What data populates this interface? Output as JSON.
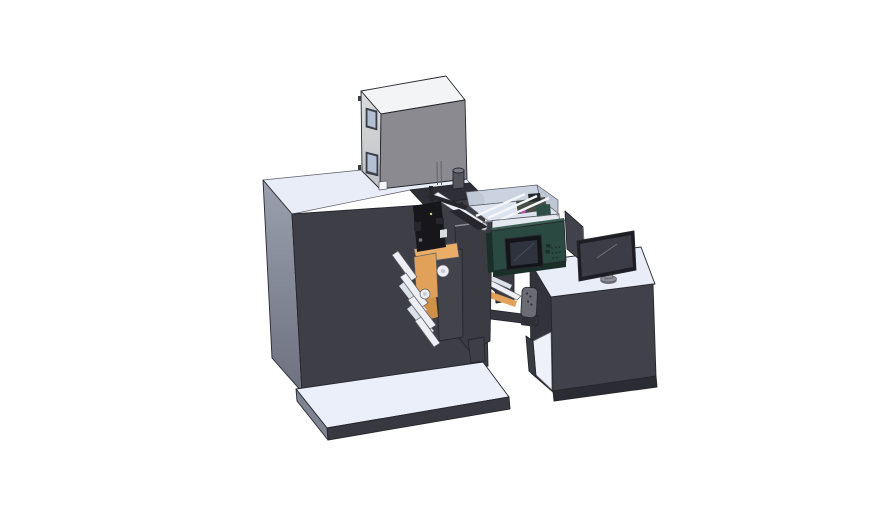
{
  "scene": {
    "description": "Isometric 3D CAD rendering of a compact label printing press: dark cabinet on a light base platform, top-mounted grey dryer box, unwind and rewind web rollers with orange material rolls, a transparent print-engine enclosure, a teal HMI screen unit, and an operator desk with a desktop monitor.",
    "background_color": "#ffffff"
  },
  "parts": {
    "machine_body": {
      "label": "main-press-cabinet"
    },
    "base_platform": {
      "label": "floor-base-platform"
    },
    "dryer_box": {
      "label": "top-dryer-box"
    },
    "web_section": {
      "label": "unwind-rewind-web-path"
    },
    "print_enclosure": {
      "label": "transparent-print-engine-enclosure"
    },
    "hmi_unit": {
      "label": "teal-hmi-screen-unit"
    },
    "operator_desk": {
      "label": "operator-desk"
    },
    "monitor": {
      "label": "desktop-monitor"
    }
  },
  "colors": {
    "bg": "#ffffff",
    "machine_top": "#e8edf7",
    "machine_front": "#3e3e47",
    "machine_side_top": "#9aa0ae",
    "machine_side_bottom": "#6d7180",
    "machine_top_strip": "#2e2e36",
    "base_top": "#eaeff9",
    "base_front": "#383841",
    "base_side": "#7e8492",
    "box_top": "#f3f4f6",
    "box_left_top": "#dadcde",
    "box_left_bottom": "#bfc1c4",
    "box_front": "#8a8a90",
    "box_outline": "#3b3b42",
    "window_frame": "#3d434e",
    "window_glass": "#b3c0d4",
    "slit": "#63636a",
    "cylinder_body": "#55555d",
    "cylinder_top": "#7b7b83",
    "white_square": "#f5f6f8",
    "desk_top": "#e8edf7",
    "desk_front": "#41414b",
    "desk_base": "#2b2b34",
    "desk_side": "#33333c",
    "shelf_white": "#eef1f8",
    "desk_leg": "#3a3a44",
    "encl_back": "#c8d1df",
    "encl_floor": "#dce3ee",
    "encl_right": "#b7c0cf",
    "encl_front": "#cdd5e2",
    "rail": "#f4f6fa",
    "encl_contents": "#474c44",
    "contents_dark": "#23282b",
    "contents_teal": "#2f4f46",
    "magenta": "#bd4fb3",
    "teal_front": "#2a4940",
    "teal_top": "#3c5f53",
    "teal_dark": "#1b2f29",
    "screen_bezel": "#141519",
    "screen_face": "#2e333d",
    "screen_hi": "#4a5260",
    "plate_dark": "#43434c",
    "column_dark": "#3b3b44",
    "plate_bevel": "#8d8d97",
    "orange": "#e2a159",
    "orange_light": "#e9ad68",
    "orange_dark": "#d0904a",
    "roller_fill": "#edeff4",
    "roller_core": "#c6cad4",
    "guide_fill": "#dde1e9",
    "black_part": "#17171b",
    "black_part2": "#26262c",
    "white_bit": "#d9dce3",
    "led": "#c9d964",
    "beam": "#36363f",
    "gplate": "#6b6b74",
    "gplate_dot": "#35353c",
    "web_bar": "#2f2f37",
    "monitor_bezel": "#1d1d23",
    "monitor_screen": "#3c3c46",
    "monitor_hi": "#6f6f7a",
    "stand": "#8f8f98",
    "stand_dark": "#6f6f78",
    "panel": "#42424c"
  }
}
